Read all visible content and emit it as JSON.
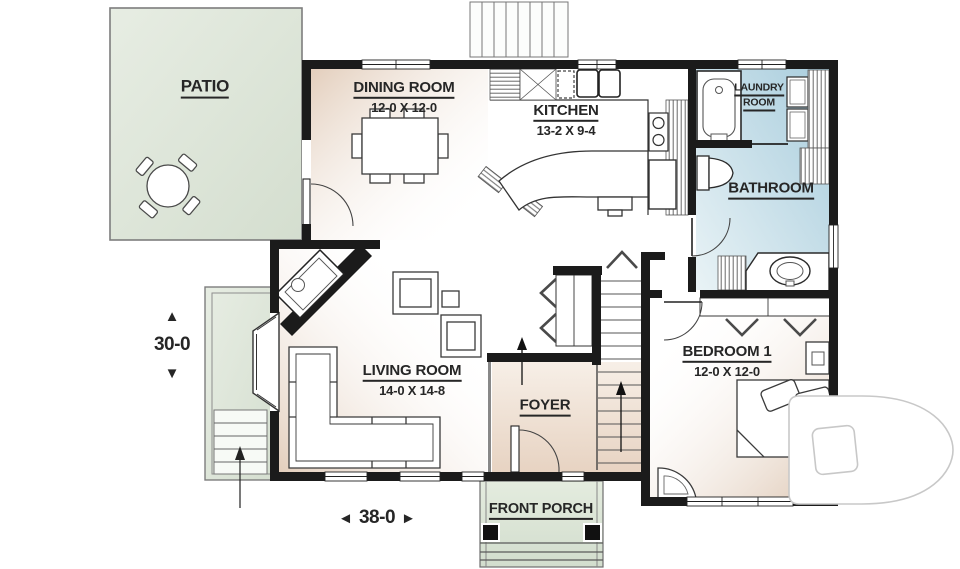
{
  "rooms": {
    "patio": {
      "label": "PATIO"
    },
    "dining_room": {
      "label": "DINING ROOM",
      "dims": "12-0 X 12-0"
    },
    "kitchen": {
      "label": "KITCHEN",
      "dims": "13-2 X 9-4"
    },
    "laundry_room": {
      "lines": [
        "LAUNDRY",
        "ROOM"
      ]
    },
    "bathroom": {
      "label": "BATHROOM"
    },
    "bedroom1": {
      "label": "BEDROOM 1",
      "dims": "12-0 X 12-0"
    },
    "living_room": {
      "label": "LIVING ROOM",
      "dims": "14-0 X 14-8"
    },
    "foyer": {
      "label": "FOYER"
    },
    "front_porch": {
      "label": "FRONT PORCH"
    }
  },
  "dimensions": {
    "overall_depth": {
      "value": "30-0",
      "arrow_up": "▲",
      "arrow_down": "▼"
    },
    "overall_width": {
      "value": "38-0",
      "arrow_left": "◄",
      "arrow_right": "►"
    }
  },
  "watermark": {
    "letter": "D"
  },
  "colors": {
    "wall": "#1b1b1b",
    "patio_fill": "#dee6da",
    "porch_fill": "#dbe6d7",
    "bathroom_blue": "#b2d3e0",
    "room_beige": "#e5d0be",
    "label_text": "#262626",
    "watermark_outline": "#c8c8c8"
  }
}
